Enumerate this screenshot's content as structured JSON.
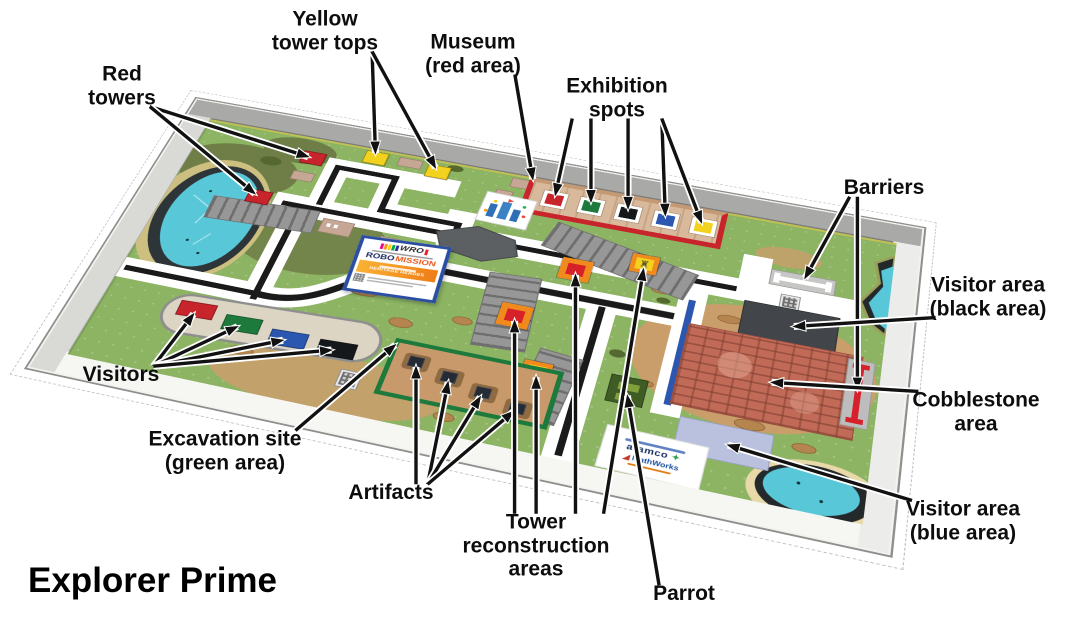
{
  "title": "Explorer Prime",
  "sign": {
    "wro": "WRO",
    "robo": "ROBO",
    "mission": "MISSION",
    "theme": "HERITAGE HEROES"
  },
  "partner_tile": {
    "partner_1": "aramco",
    "partner_2": "MathWorks"
  },
  "icons": {
    "tower_glyph": "♜",
    "partner_star": "✦",
    "partner_triangle": "◢"
  },
  "palette": {
    "grass": "#8cb463",
    "road_white": "#ffffff",
    "road_line_black": "#1a1a1a",
    "road_line_blue": "#2b57b0",
    "water": "#58c8d8",
    "shore_dark": "#2e3538",
    "sand": "#cdbf80",
    "museum_tan": "#d9b99b",
    "museum_border_red": "#c8242b",
    "excavation_green": "#1e7a3c",
    "excavation_dirt": "#c89a6b",
    "cobblestone": "#c06a57",
    "visitor_area_black": "#42464a",
    "visitor_area_blue": "#b9c1df",
    "tower_red": "#c8242b",
    "tower_top_yellow": "#f2d21f",
    "recon_orange": "#f08a1d",
    "barrier_gray": "#c6c6c4",
    "barrier_red": "#d6202a",
    "ruin_gray": "#979797",
    "parking_beige": "#dcd5c3",
    "table_frame": "#f2f2ef",
    "wall_gray": "#a9a9a7"
  },
  "labels": [
    {
      "id": "yellow-tower-tops",
      "lines": [
        "Yellow",
        "tower tops"
      ],
      "targets": [
        "yellow-top-1",
        "yellow-top-2"
      ]
    },
    {
      "id": "red-towers",
      "lines": [
        "Red",
        "towers"
      ],
      "targets": [
        "red-tower-1",
        "red-tower-2"
      ]
    },
    {
      "id": "museum",
      "lines": [
        "Museum",
        "(red area)"
      ],
      "targets": [
        "museum-anchor"
      ]
    },
    {
      "id": "exhibition-spots",
      "lines": [
        "Exhibition",
        "spots"
      ],
      "targets": [
        "spot-red",
        "spot-green",
        "spot-black",
        "spot-blue",
        "spot-yellow"
      ]
    },
    {
      "id": "barriers",
      "lines": [
        "Barriers"
      ],
      "targets": [
        "barrier-1",
        "barrier-2"
      ]
    },
    {
      "id": "visitor-black",
      "lines": [
        "Visitor area",
        "(black area)"
      ],
      "targets": [
        "black-area"
      ]
    },
    {
      "id": "cobblestone",
      "lines": [
        "Cobblestone",
        "area"
      ],
      "targets": [
        "cobblestone-area"
      ]
    },
    {
      "id": "visitor-blue",
      "lines": [
        "Visitor area",
        "(blue area)"
      ],
      "targets": [
        "blue-area"
      ]
    },
    {
      "id": "visitors",
      "lines": [
        "Visitors"
      ],
      "targets": [
        "visitor-red",
        "visitor-green",
        "visitor-blue",
        "visitor-black"
      ]
    },
    {
      "id": "excavation-site",
      "lines": [
        "Excavation site",
        "(green area)"
      ],
      "targets": [
        "excavation-anchor"
      ]
    },
    {
      "id": "artifacts",
      "lines": [
        "Artifacts"
      ],
      "targets": [
        "artifact-1",
        "artifact-2",
        "artifact-3",
        "artifact-4"
      ]
    },
    {
      "id": "tower-reconstruction",
      "lines": [
        "Tower",
        "reconstruction",
        "areas"
      ],
      "targets": [
        "recon-1",
        "recon-2",
        "recon-3",
        "recon-4"
      ]
    },
    {
      "id": "parrot",
      "lines": [
        "Parrot"
      ],
      "targets": [
        "parrot"
      ]
    }
  ]
}
